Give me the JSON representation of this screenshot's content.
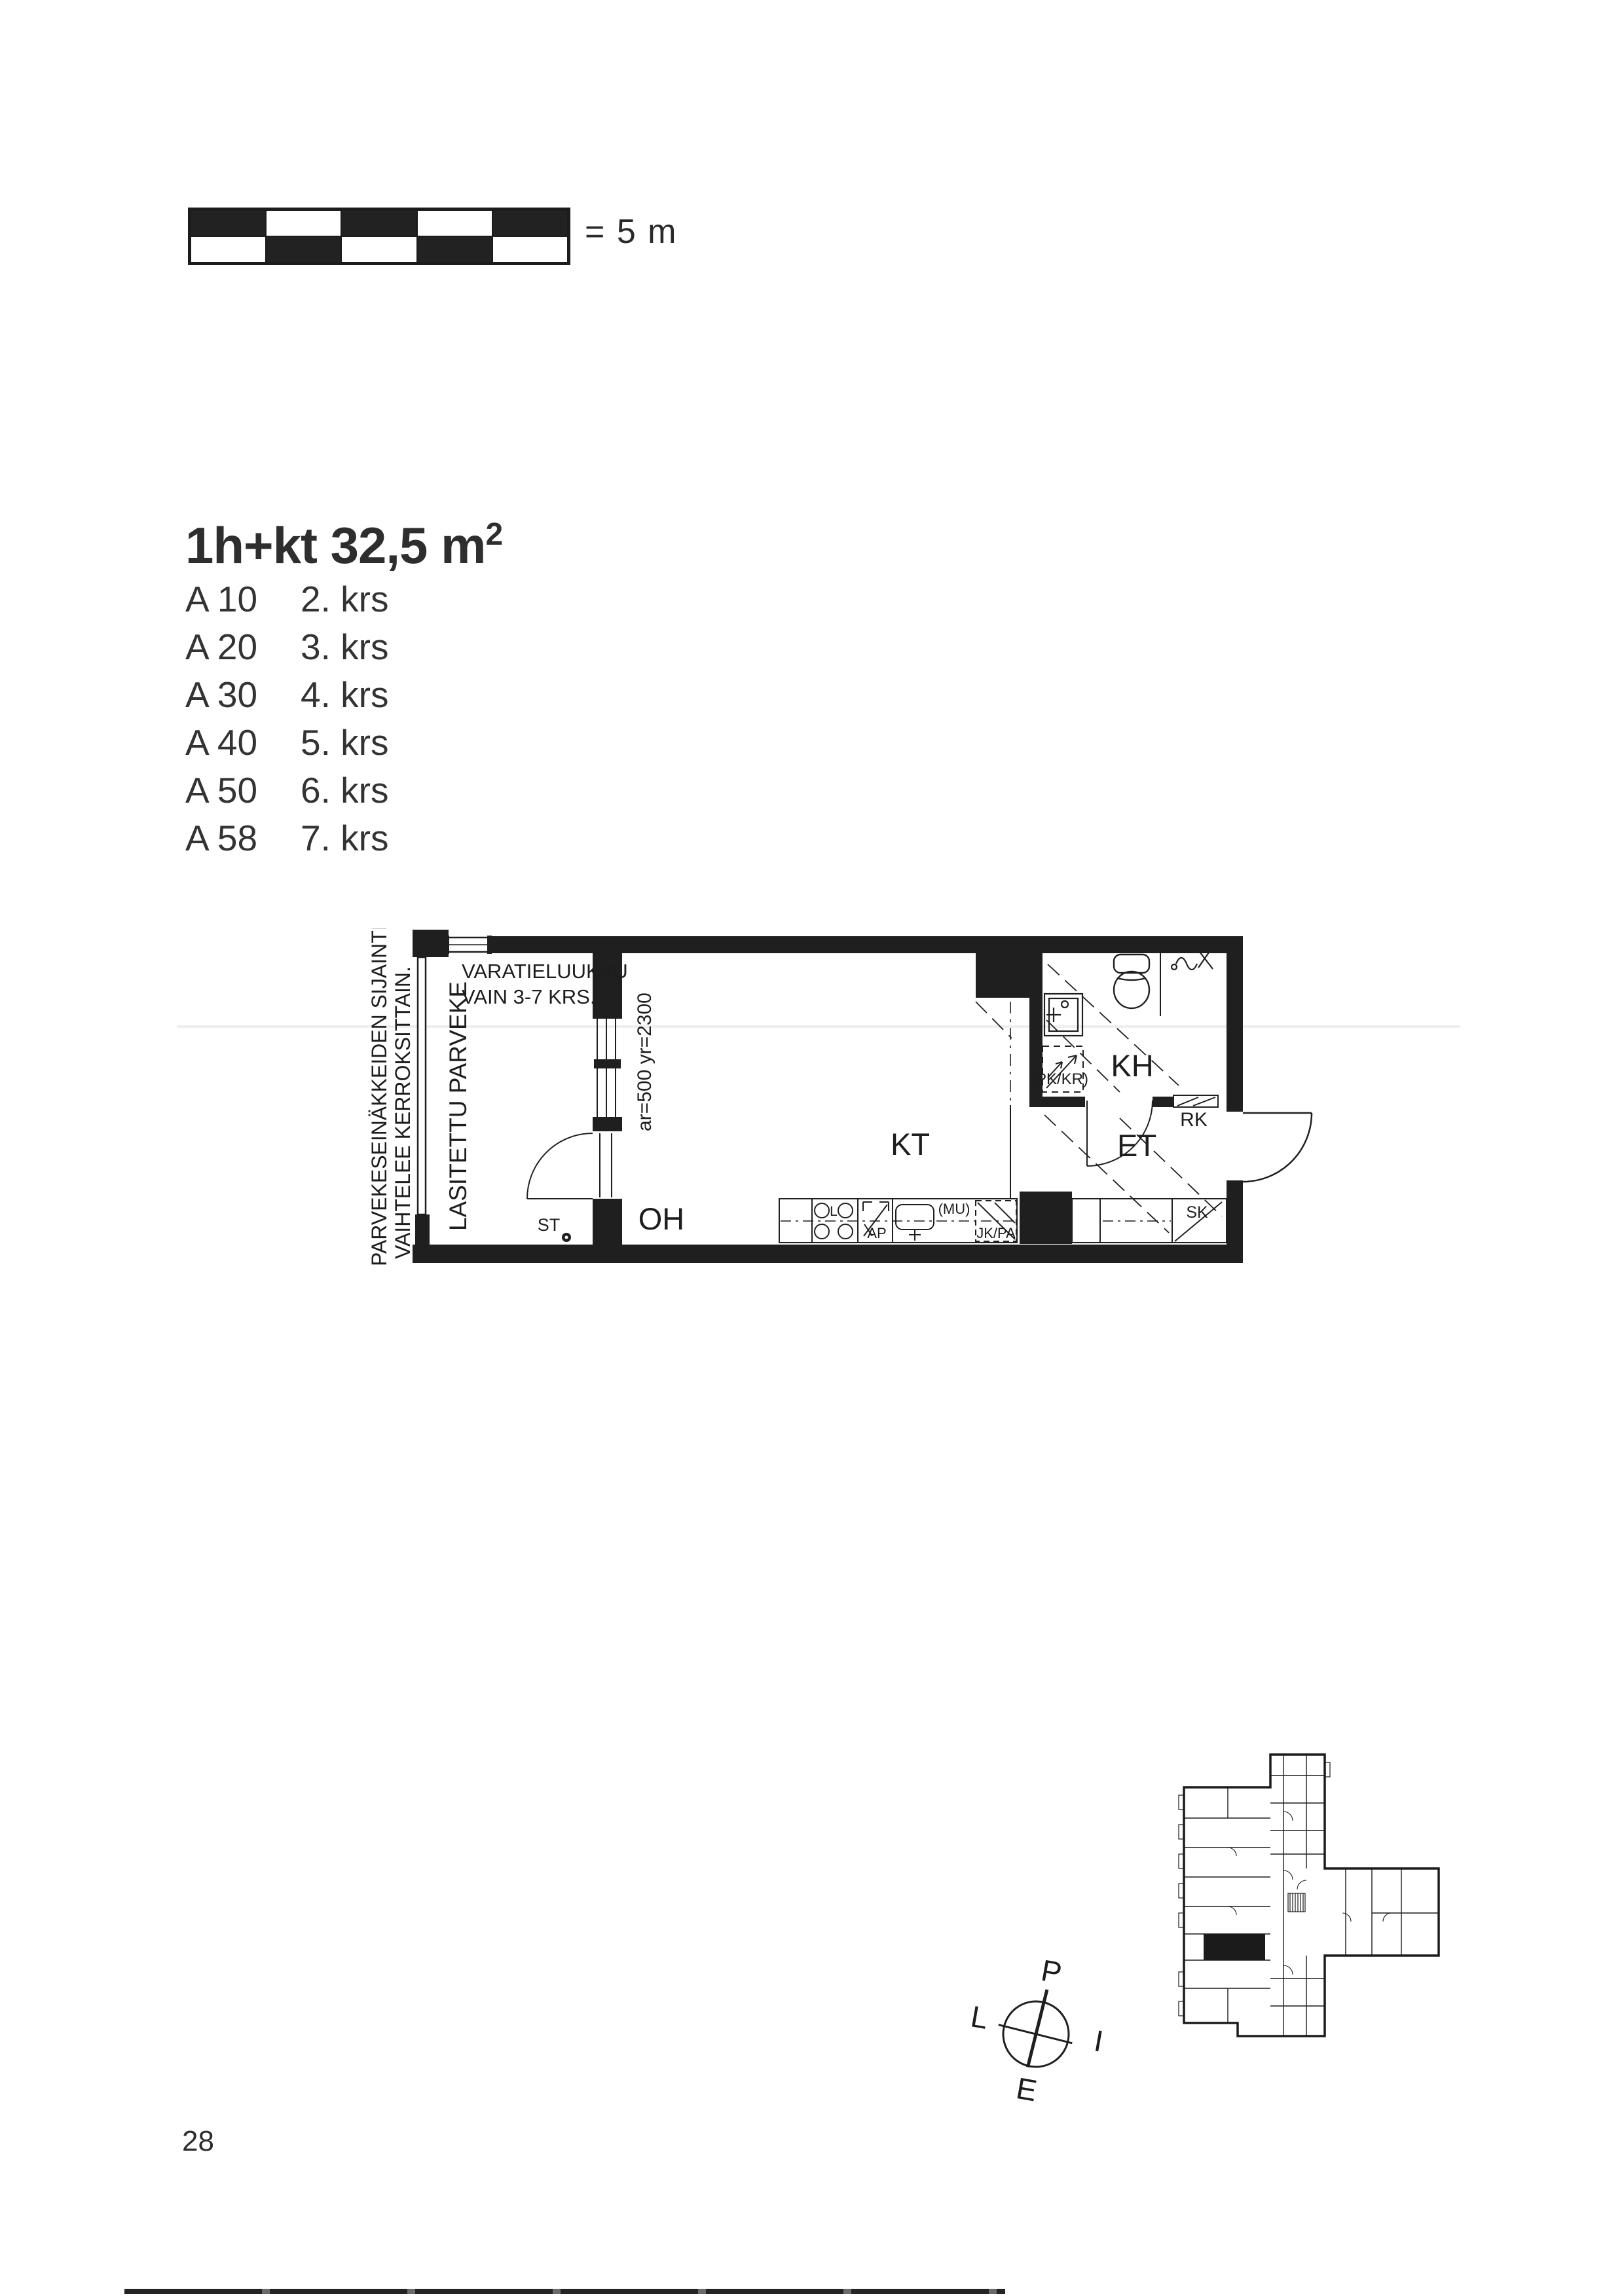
{
  "page": {
    "number": "28"
  },
  "scale_bar": {
    "label": "= 5 m"
  },
  "listing": {
    "title_main": "1h+kt 32,5 m",
    "title_sup": "2",
    "apartments": [
      {
        "code": "A 10",
        "floor": "2. krs"
      },
      {
        "code": "A 20",
        "floor": "3. krs"
      },
      {
        "code": "A 30",
        "floor": "4. krs"
      },
      {
        "code": "A 40",
        "floor": "5. krs"
      },
      {
        "code": "A 50",
        "floor": "6. krs"
      },
      {
        "code": "A 58",
        "floor": "7. krs"
      }
    ]
  },
  "floor_plan": {
    "side_note_line1": "PARVEKESEINÄKKEIDEN SIJAINTI",
    "side_note_line2": "VAIHTELEE KERROKSITTAIN.",
    "hatch_note_line1": "VARATIELUUKKU",
    "hatch_note_line2": "VAIN 3-7 KRS.",
    "balcony_label": "LASITETTU PARVEKE",
    "window_dim": "ar=500 yr=2300",
    "rooms": {
      "living": "OH",
      "kitchen": "KT",
      "bathroom": "KH",
      "hall": "ET"
    },
    "fixtures": {
      "stove": "L",
      "dishwasher": "AP",
      "microwave": "(MU)",
      "fridge": "JK/PA",
      "washer": "(PK/KR)",
      "cabinet": "RK",
      "cleaning_closet": "SK",
      "socket": "ST"
    }
  },
  "compass": {
    "north": "P",
    "east": "I",
    "south": "E",
    "west": "L"
  }
}
